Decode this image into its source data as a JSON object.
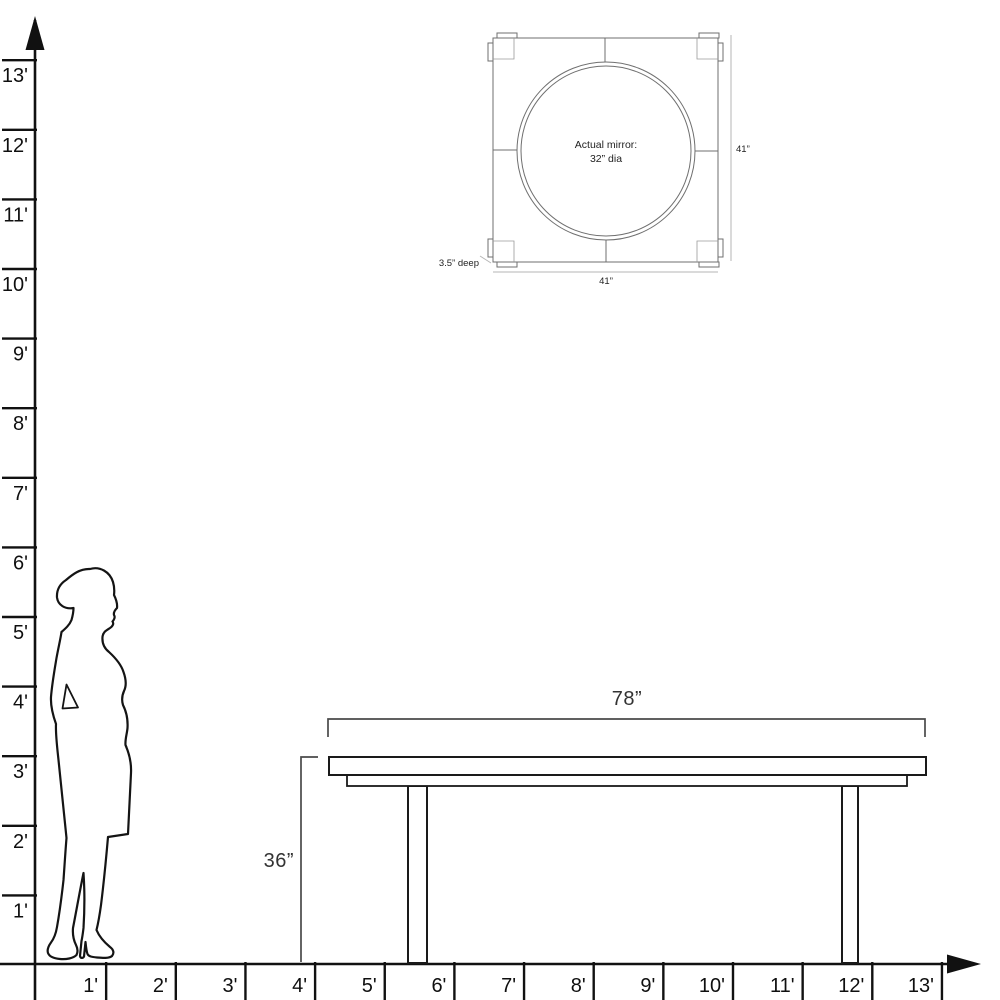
{
  "ruler": {
    "vertical": {
      "labels": [
        "1'",
        "2'",
        "3'",
        "4'",
        "5'",
        "6'",
        "7'",
        "8'",
        "9'",
        "10'",
        "11'",
        "12'",
        "13'"
      ]
    },
    "horizontal": {
      "labels": [
        "1'",
        "2'",
        "3'",
        "4'",
        "5'",
        "6'",
        "7'",
        "8'",
        "9'",
        "10'",
        "11'",
        "12'",
        "13'"
      ]
    }
  },
  "table": {
    "width_label": "78”",
    "height_label": "36”"
  },
  "mirror": {
    "text_line1": "Actual mirror:",
    "text_line2": "32” dia",
    "height_label": "41”",
    "width_label": "41”",
    "depth_label": "3.5” deep"
  },
  "colors": {
    "axis": "#111111",
    "furniture_stroke": "#1a1a1a",
    "dimension_stroke": "#4a4a4a",
    "dimension_label": "#333333",
    "mirror_stroke": "#6f6f6f",
    "mirror_dim_stroke": "#b5b5b5",
    "background": "#ffffff"
  }
}
